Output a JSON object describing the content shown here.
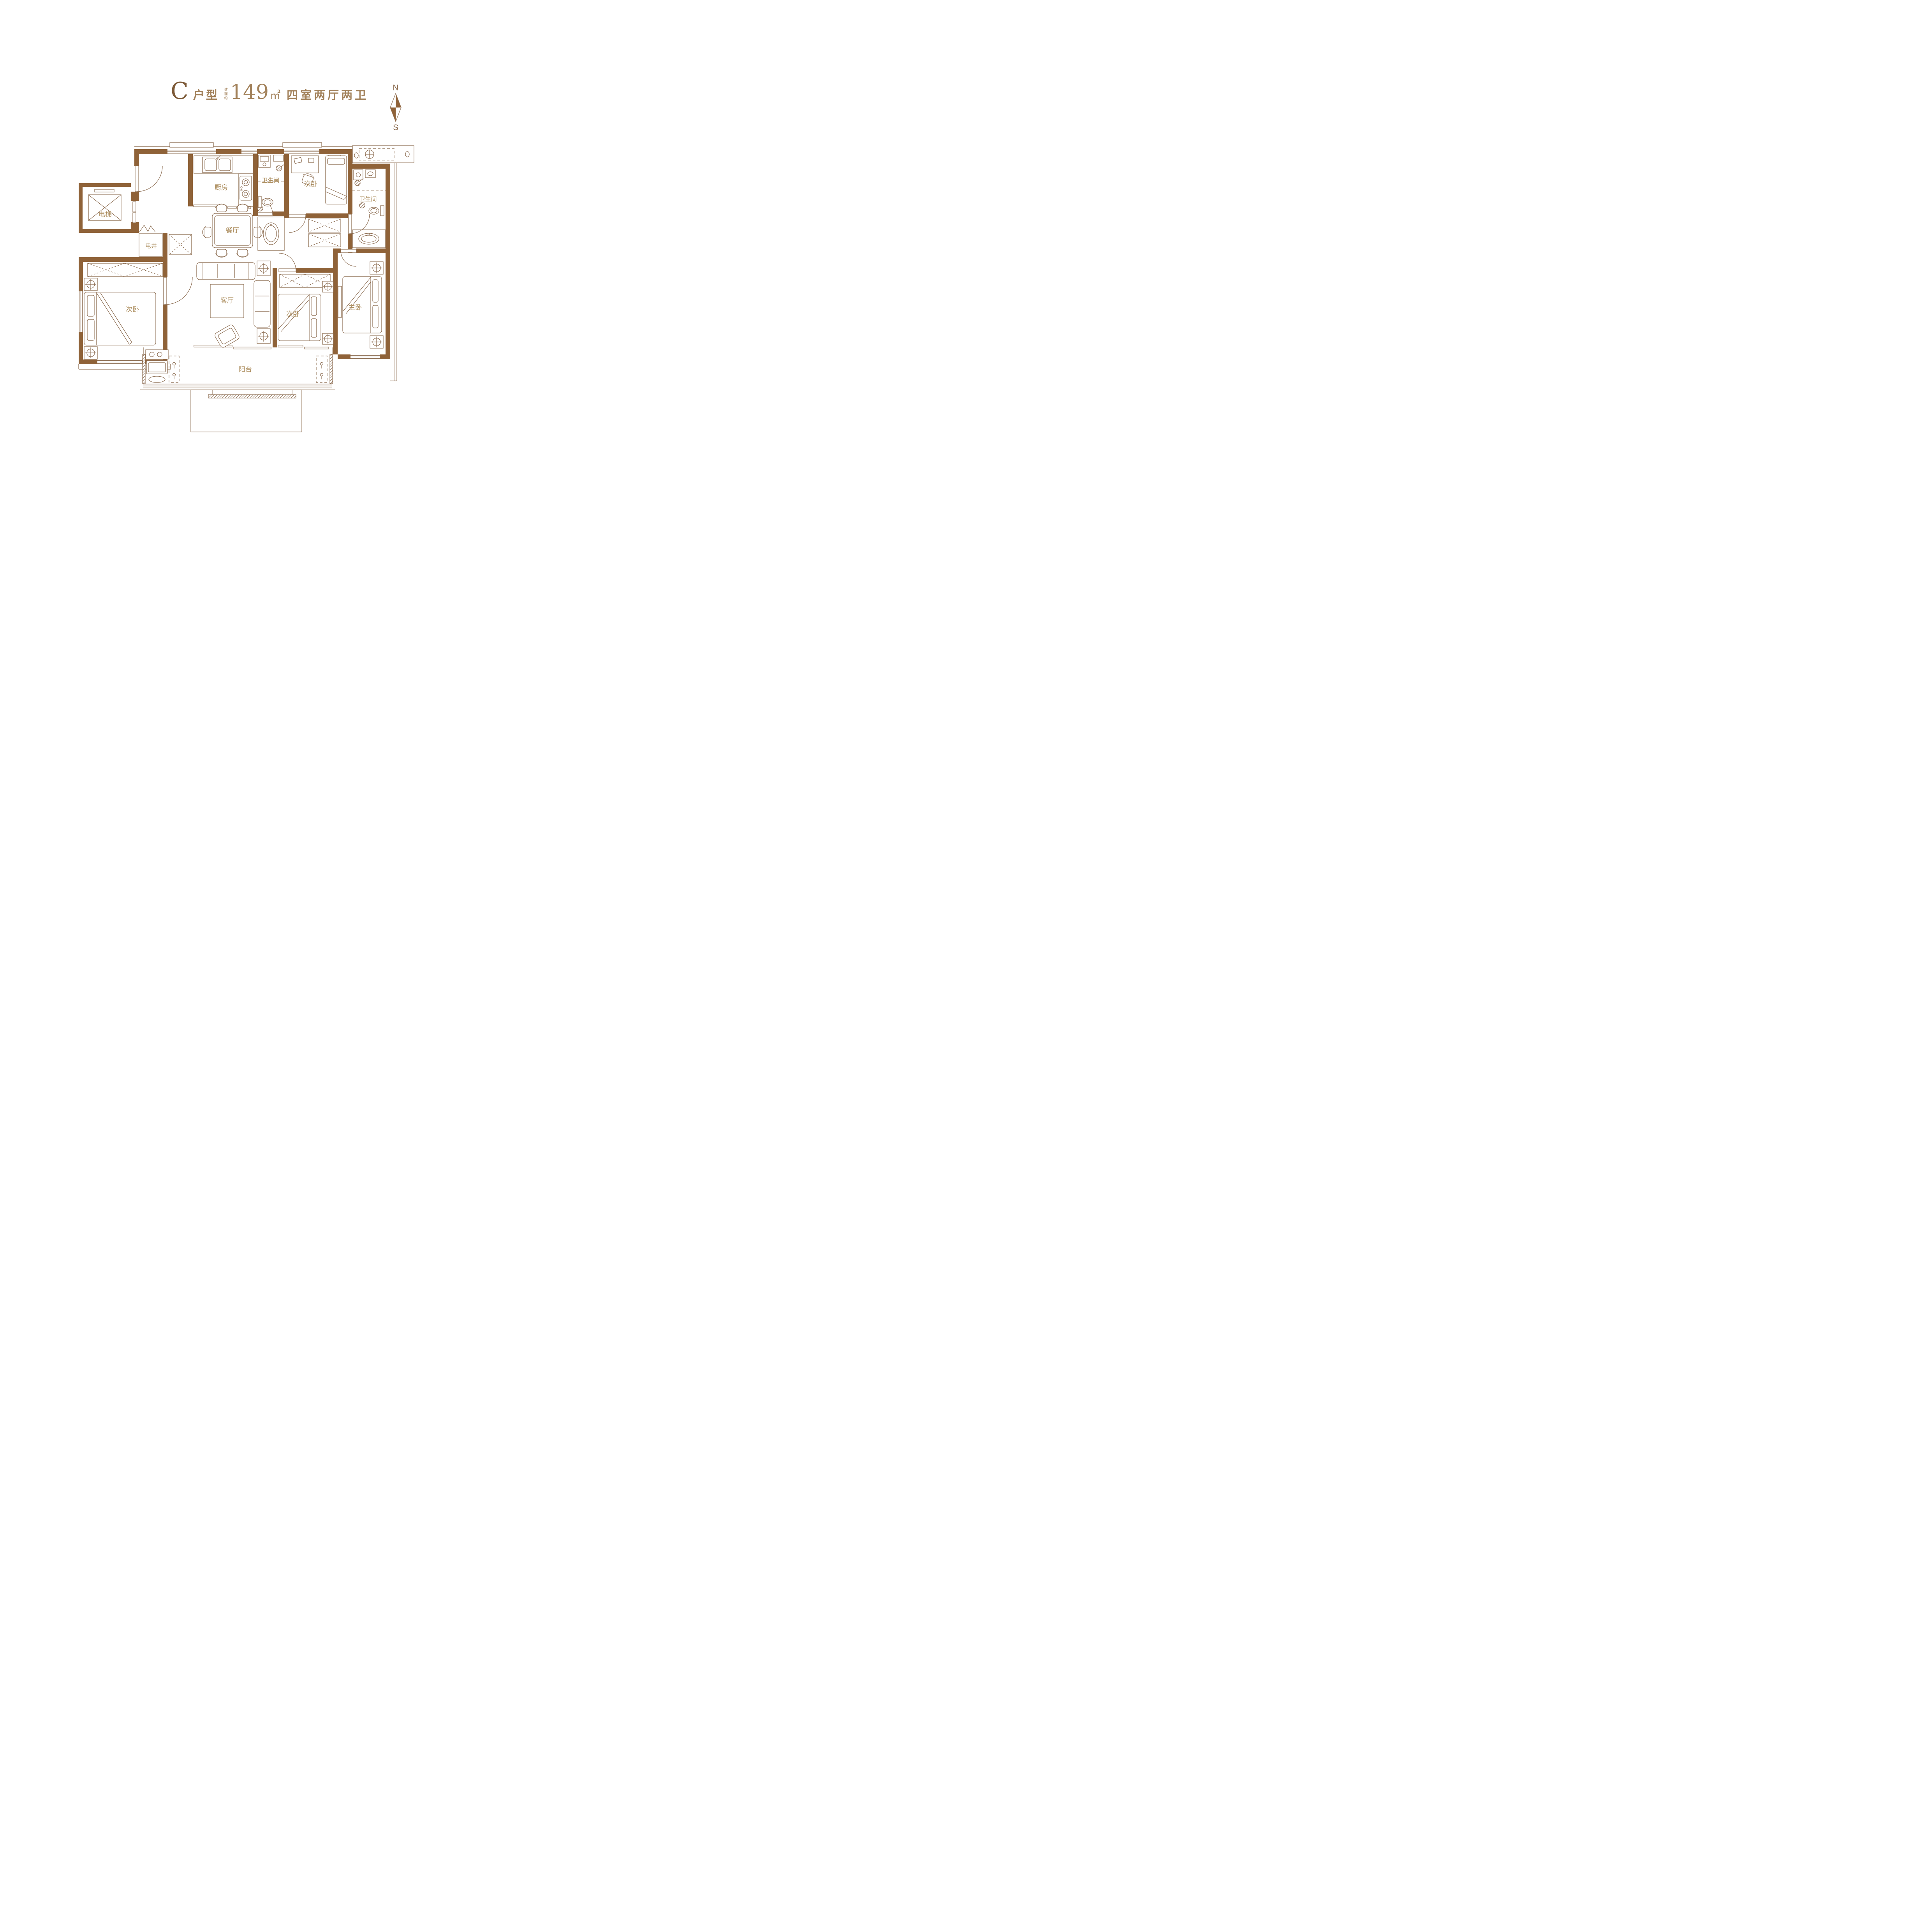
{
  "title": {
    "unit_letter": "C",
    "unit_type_label": "户型",
    "area_prefix": "建面约",
    "area_value": "149",
    "area_unit": "㎡",
    "layout_description": "四室两厅两卫"
  },
  "compass": {
    "north_label": "N",
    "south_label": "S"
  },
  "rooms": {
    "elevator": {
      "label": "电梯"
    },
    "utility_shaft": {
      "label": "电井"
    },
    "kitchen": {
      "label": "厨房"
    },
    "dining_room": {
      "label": "餐厅"
    },
    "bathroom_north": {
      "label": "卫生间"
    },
    "bathroom_east": {
      "label": "卫生间"
    },
    "bedroom_north": {
      "label": "次卧"
    },
    "bedroom_west": {
      "label": "次卧"
    },
    "bedroom_middle": {
      "label": "次卧"
    },
    "master_bedroom": {
      "label": "主卧"
    },
    "living_room": {
      "label": "客厅"
    },
    "balcony": {
      "label": "阳台"
    }
  },
  "colors": {
    "wall": "#8f6238",
    "line": "#8a6a4e",
    "label": "#ab8c5c",
    "title": "#7d5a38",
    "titleLight": "#a2815a"
  }
}
